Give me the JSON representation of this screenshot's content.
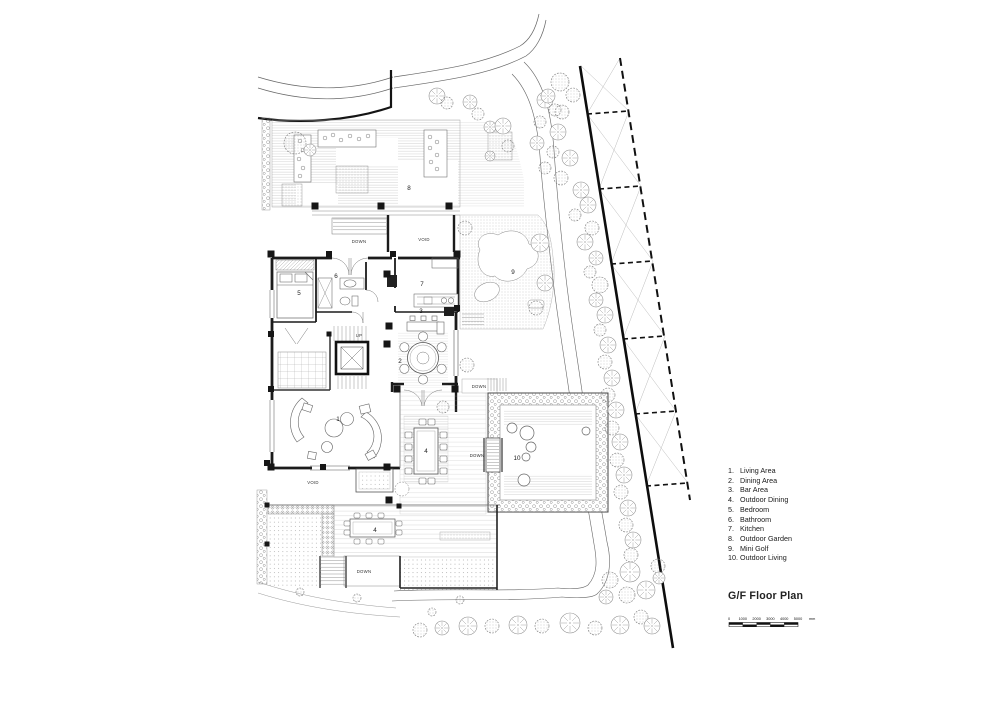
{
  "plan": {
    "labels": {
      "down": "DOWN",
      "void": "VOID",
      "up": "UP"
    },
    "rooms": {
      "living": "1",
      "dining": "2",
      "bar": "3",
      "outdoor_dining": "4",
      "bedroom": "5",
      "bathroom": "6",
      "kitchen": "7",
      "outdoor_garden": "8",
      "mini_golf": "9",
      "outdoor_living": "10"
    }
  },
  "legend": {
    "items": [
      {
        "num": "1.",
        "label": "Living Area"
      },
      {
        "num": "2.",
        "label": "Dining Area"
      },
      {
        "num": "3.",
        "label": "Bar Area"
      },
      {
        "num": "4.",
        "label": "Outdoor Dining"
      },
      {
        "num": "5.",
        "label": "Bedroom"
      },
      {
        "num": "6.",
        "label": "Bathroom"
      },
      {
        "num": "7.",
        "label": "Kitchen"
      },
      {
        "num": "8.",
        "label": "Outdoor Garden"
      },
      {
        "num": "9.",
        "label": "Mini Golf"
      },
      {
        "num": "10.",
        "label": "Outdoor Living"
      }
    ]
  },
  "title": "G/F Floor Plan",
  "scale_bar": {
    "ticks": [
      "0",
      "1000",
      "2000",
      "3000",
      "4000",
      "5000"
    ],
    "unit": "mm"
  }
}
